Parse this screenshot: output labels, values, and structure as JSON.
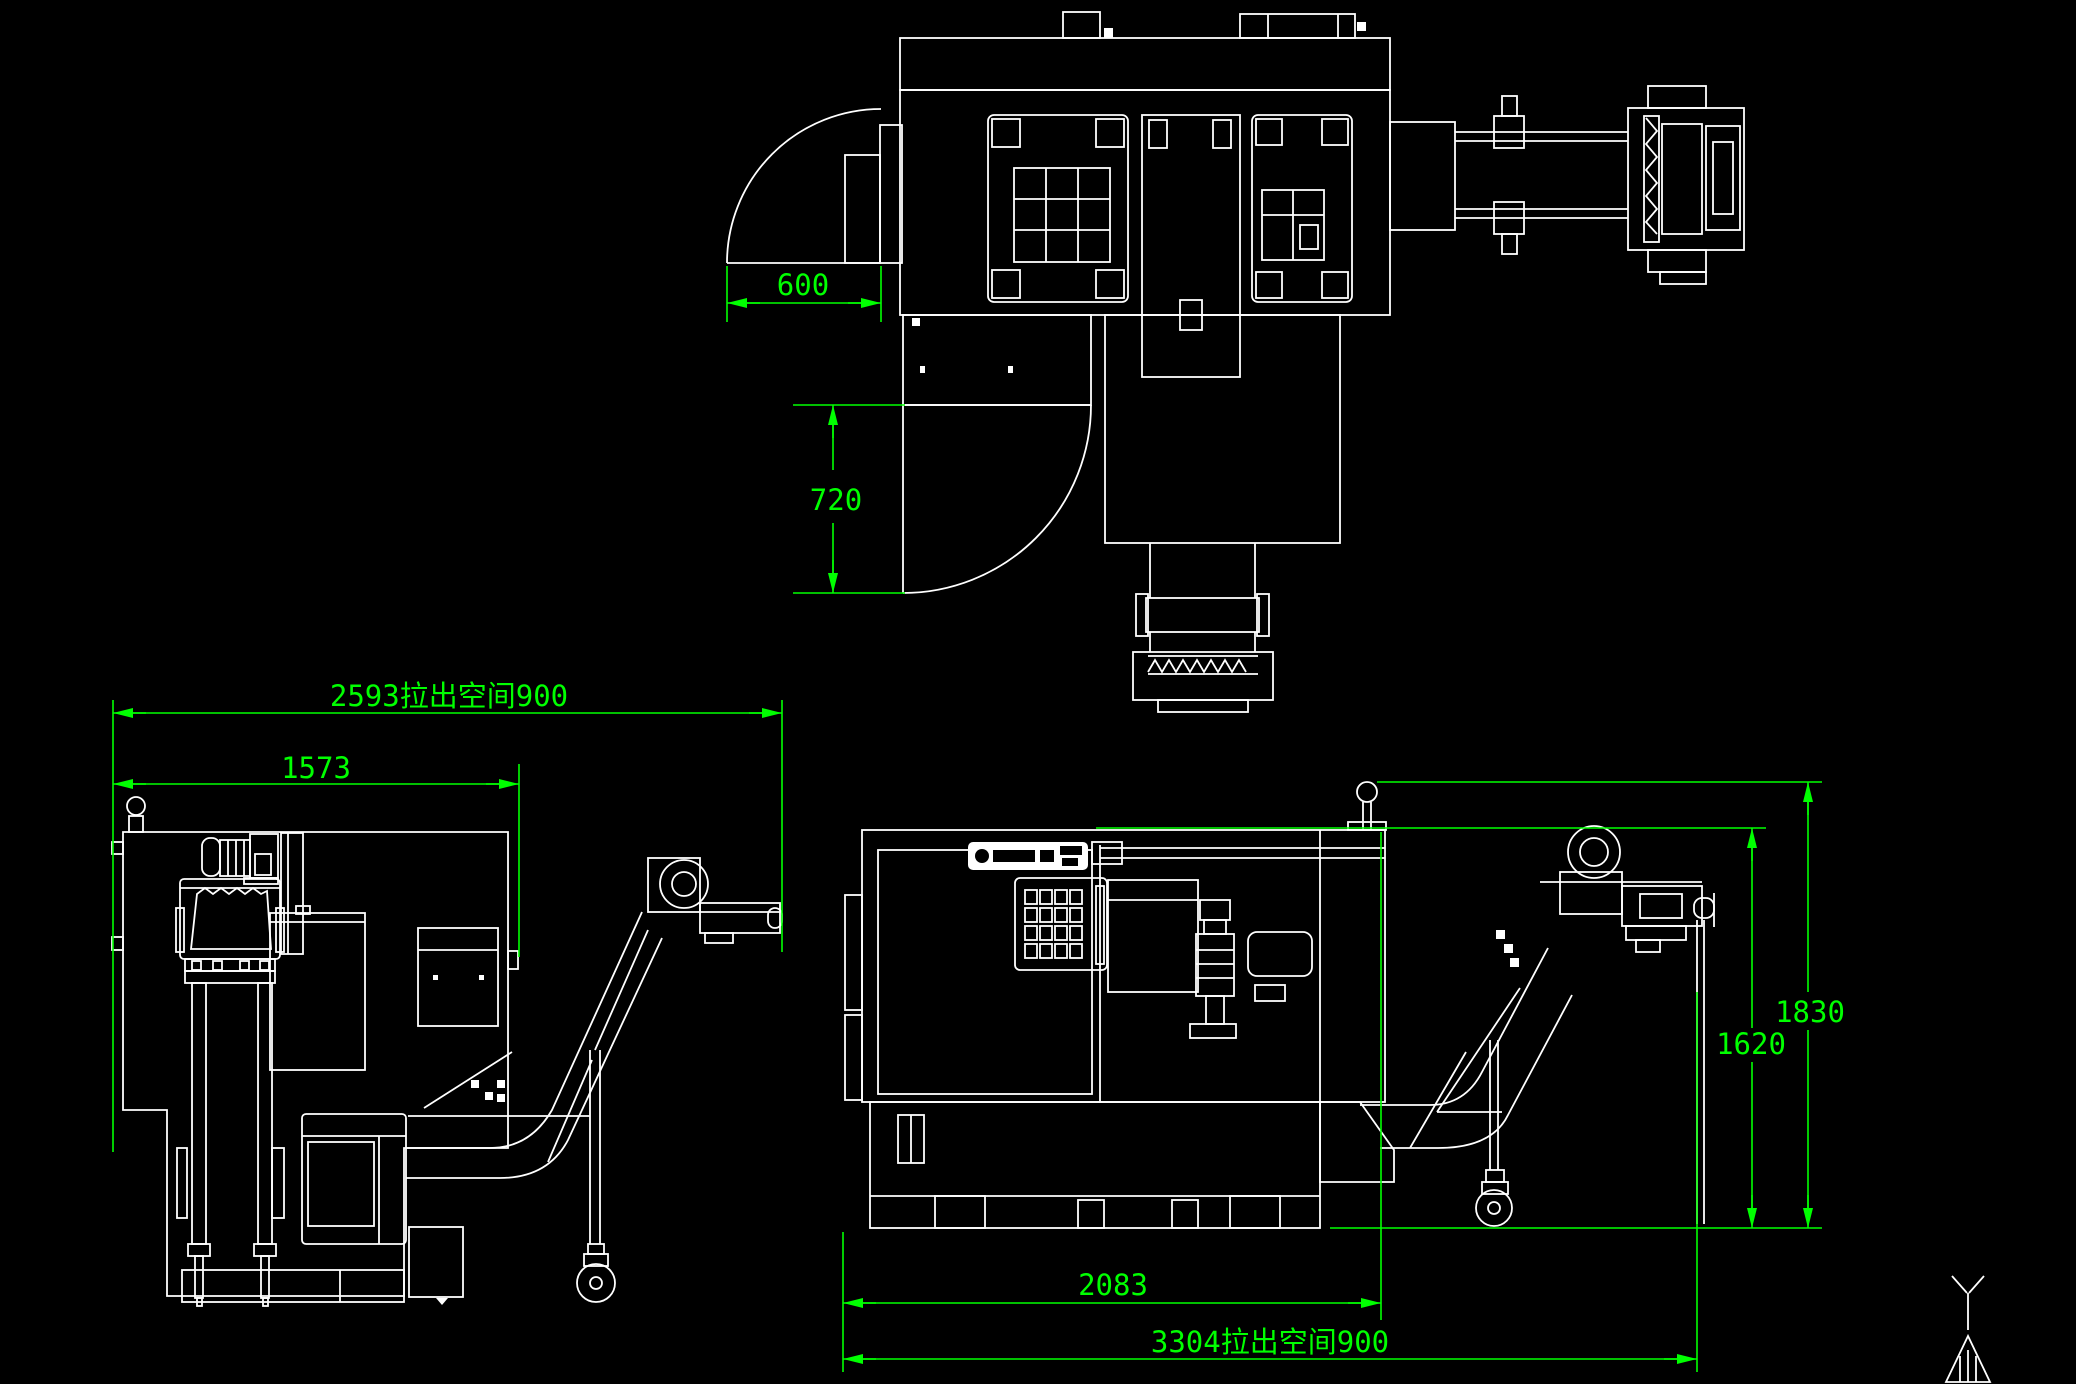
{
  "app": {
    "type": "cad-drawing-viewport",
    "background_color": "#000000",
    "geometry_color": "#FFFFFF",
    "dimension_color": "#00FF00"
  },
  "dims": {
    "d600": "600",
    "d720": "720",
    "d2593": "2593拉出空间900",
    "d1573": "1573",
    "d1830": "1830",
    "d1620": "1620",
    "d2083": "2083",
    "d3304": "3304拉出空间900"
  },
  "views": {
    "plan_view": "machine plan view with door swing arcs and chip conveyors",
    "rear_view": "machine rear elevation with chip conveyor and caster",
    "front_view": "machine front elevation with control keypad, chip conveyor and caster"
  },
  "icons": {
    "ucs": "y-axis-datum-icon"
  }
}
